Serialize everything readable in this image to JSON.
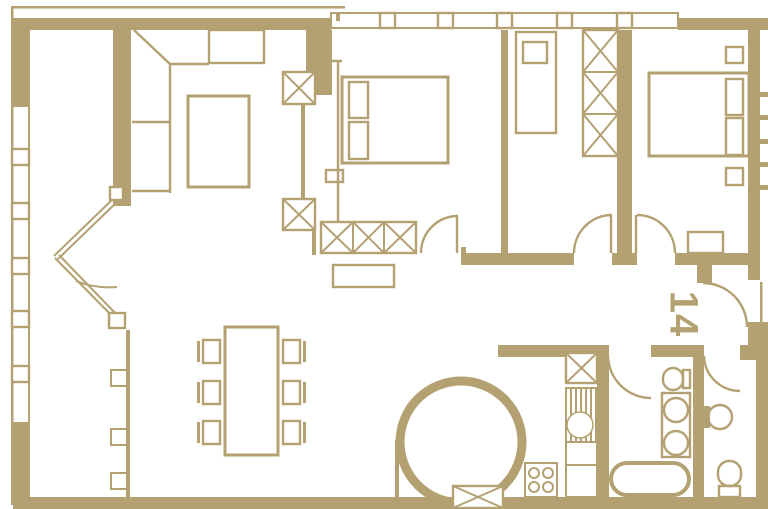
{
  "plan": {
    "unit_number": "14",
    "colors": {
      "wall": "#b3a172",
      "background": "#ffffff"
    },
    "elements": {
      "unit_label": "apartment number 14, rotated 90 degrees, beside entry door",
      "rooms": "living-dining room, bedroom, study, bedroom, kitchen, bathroom, wc, hall",
      "fixtures": "bathtub, two toilets, double vanity, round basin, stove, sink, circular structure"
    }
  }
}
